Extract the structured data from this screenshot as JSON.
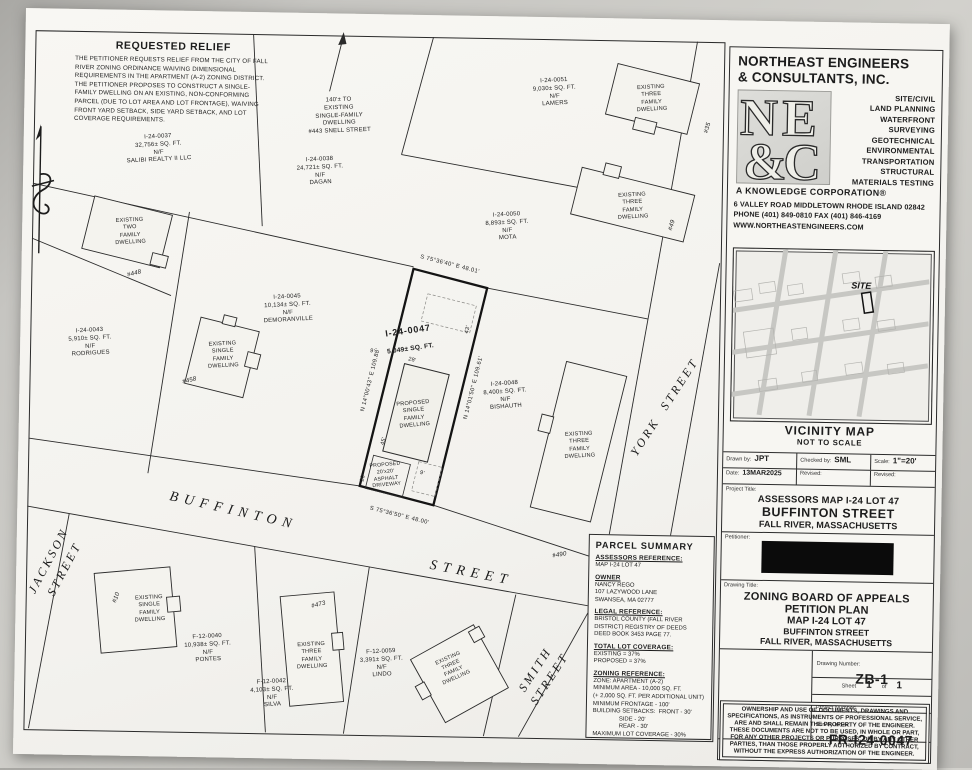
{
  "requested_relief": {
    "title": "REQUESTED RELIEF",
    "body": "THE PETITIONER REQUESTS RELIEF FROM THE CITY OF FALL RIVER ZONING ORDINANCE WAIVING DIMENSIONAL REQUIREMENTS IN THE APARTMENT (A-2) ZONING DISTRICT. THE PETITIONER PROPOSES TO CONSTRUCT A SINGLE-FAMILY DWELLING ON AN EXISTING, NON-CONFORMING PARCEL (DUE TO LOT AREA AND LOT FRONTAGE), WAIVING FRONT YARD SETBACK, SIDE YARD SETBACK, AND LOT COVERAGE REQUIREMENTS."
  },
  "note_140": "140'± TO\nEXISTING\nSINGLE-FAMILY\nDWELLING\n#443 SNELL STREET",
  "parcels": [
    {
      "id": "I-24-0037",
      "area": "32,756± SQ. FT.",
      "nf": "N/F",
      "owner": "SALIBI REALTY II LLC"
    },
    {
      "id": "I-24-0038",
      "area": "24,721± SQ. FT.",
      "nf": "N/F",
      "owner": "DAGAN"
    },
    {
      "id": "I-24-0051",
      "area": "9,030± SQ. FT.",
      "nf": "N/F",
      "owner": "LAMERS"
    },
    {
      "id": "I-24-0050",
      "area": "8,893± SQ. FT.",
      "nf": "N/F",
      "owner": "MOTA"
    },
    {
      "id": "I-24-0043",
      "area": "5,910± SQ. FT.",
      "nf": "N/F",
      "owner": "RODRIGUES"
    },
    {
      "id": "I-24-0045",
      "area": "10,134± SQ. FT.",
      "nf": "N/F",
      "owner": "DEMORANVILLE"
    },
    {
      "id": "I-24-0048",
      "area": "8,400± SQ. FT.",
      "nf": "N/F",
      "owner": "BISHAUTH"
    },
    {
      "id": "F-12-0040",
      "area": "10,938± SQ. FT.",
      "nf": "N/F",
      "owner": "PONTES"
    },
    {
      "id": "F-12-0042",
      "area": "4,103± SQ. FT.",
      "nf": "N/F",
      "owner": "SILVA"
    },
    {
      "id": "F-12-0059",
      "area": "3,391± SQ. FT.",
      "nf": "N/F",
      "owner": "LINDO"
    }
  ],
  "subject_parcel": {
    "id": "I-24-0047",
    "area": "5,049± SQ. FT."
  },
  "proposed": {
    "dwelling": "PROPOSED\nSINGLE\nFAMILY\nDWELLING",
    "driveway": "PROPOSED\n20'x20'\nASPHALT\nDRIVEWAY"
  },
  "dwellings": {
    "three_family": "EXISTING\nTHREE\nFAMILY\nDWELLING",
    "two_family": "EXISTING\nTWO\nFAMILY\nDWELLING",
    "single_family": "EXISTING\nSINGLE\nFAMILY\nDWELLING",
    "h35": "#35",
    "h49": "#49",
    "h448": "#448",
    "h458": "#458",
    "h490": "#490",
    "h10": "#10",
    "h473": "#473"
  },
  "streets": {
    "buffinton": "BUFFINTON",
    "buffinton2": "STREET",
    "jackson": "JACKSON\nSTREET",
    "york": "YORK  STREET",
    "smith": "SMITH\nSTREET"
  },
  "bearings": {
    "rear": "S 75°36'40\" E   48.01'",
    "front": "S 75°36'50\" E   48.00'",
    "left": "N 14°00'43\" E   109.88'",
    "right": "N 14°01'50\" E   109.61'"
  },
  "dims": {
    "d20": "20'",
    "d45": "45'",
    "d28": "28'",
    "d9a": "9'",
    "d9b": "9'",
    "d43": "43'"
  },
  "parcel_summary": {
    "title": "PARCEL SUMMARY",
    "assessors_heading": "ASSESSORS REFERENCE:",
    "assessors_value": "MAP I-24 LOT 47",
    "owner_heading": "OWNER",
    "owner_value": "NANCY REGO\n107 LAZYWOOD LANE\nSWANSEA, MA 02777",
    "legal_heading": "LEGAL REFERENCE:",
    "legal_value": "BRISTOL COUNTY (FALL RIVER\nDISTRICT) REGISTRY OF DEEDS\nDEED BOOK 3453 PAGE 77.",
    "coverage_heading": "TOTAL LOT COVERAGE:",
    "coverage_value": "EXISTING = 37%\nPROPOSED = 37%",
    "zoning_heading": "ZONING REFERENCE:",
    "zoning_value": "ZONE: APARTMENT (A-2)\nMINIMUM AREA - 10,000 SQ. FT.\n(+ 2,000 SQ. FT. PER ADDITIONAL UNIT)\nMINIMUM FRONTAGE - 100'\nBUILDING SETBACKS:  FRONT - 30'\n                SIDE - 20'\n                REAR - 30'\nMAXIMUM LOT COVERAGE - 30%"
  },
  "company": {
    "name_line1": "NORTHEAST ENGINEERS",
    "name_line2": "& CONSULTANTS, INC.",
    "logo": {
      "n": "N",
      "e": "E",
      "amp": "&",
      "c": "C"
    },
    "services": [
      "SITE/CIVIL",
      "LAND PLANNING",
      "WATERFRONT",
      "SURVEYING",
      "GEOTECHNICAL",
      "ENVIRONMENTAL",
      "TRANSPORTATION",
      "STRUCTURAL",
      "MATERIALS TESTING"
    ],
    "tagline": "A KNOWLEDGE CORPORATION®",
    "address": "6 VALLEY ROAD MIDDLETOWN  RHODE ISLAND 02842",
    "phone_fax": "PHONE (401) 849-0810 FAX (401) 846-4169",
    "website": "WWW.NORTHEASTENGINEERS.COM"
  },
  "vicinity": {
    "site": "SITE",
    "title": "VICINITY MAP",
    "subtitle": "NOT TO SCALE"
  },
  "title_block": {
    "drawn_by_label": "Drawn by:",
    "drawn_by": "JPT",
    "checked_by_label": "Checked by:",
    "checked_by": "SML",
    "scale_label": "Scale:",
    "scale": "1\"=20'",
    "date_label": "Date:",
    "date": "13MAR2025",
    "revised_label": "Revised:",
    "revised2_label": "Revised:",
    "project_title_label": "Project Title:",
    "project_title_line1": "ASSESSORS MAP I-24 LOT 47",
    "project_title_line2": "BUFFINTON STREET",
    "project_title_line3": "FALL RIVER, MASSACHUSETTS",
    "petitioner_label": "Petitioner:",
    "drawing_title_label": "Drawing Title:",
    "drawing_title_line1": "ZONING BOARD OF APPEALS",
    "drawing_title_line2": "PETITION PLAN",
    "drawing_title_line3": "MAP I-24 LOT 47",
    "drawing_title_line4": "BUFFINTON STREET",
    "drawing_title_line5": "FALL RIVER, MASSACHUSETTS",
    "drawing_number_label": "Drawing Number:",
    "drawing_number": "ZB-1",
    "sheet_label": "Sheet",
    "sheet_no": "1",
    "sheet_of": "of",
    "sheet_total": "1",
    "project_number_label": "Project Number:",
    "survey_index_label": "Survey Index:",
    "survey_index": "FR-I24-0047",
    "disclaimer": "OWNERSHIP AND USE OF DOCUMENTS, DRAWINGS AND SPECIFICATIONS, AS INSTRUMENTS OF PROFESSIONAL SERVICE, ARE AND SHALL REMAIN THE PROPERTY OF THE ENGINEER. THESE DOCUMENTS ARE NOT TO BE USED, IN WHOLE OR PART, FOR ANY OTHER PROJECTS OR PURPOSES, OR BY ANY OTHER PARTIES, THAN THOSE PROPERLY AUTHORIZED BY CONTRACT, WITHOUT THE EXPRESS AUTHORIZATION OF THE ENGINEER."
  }
}
